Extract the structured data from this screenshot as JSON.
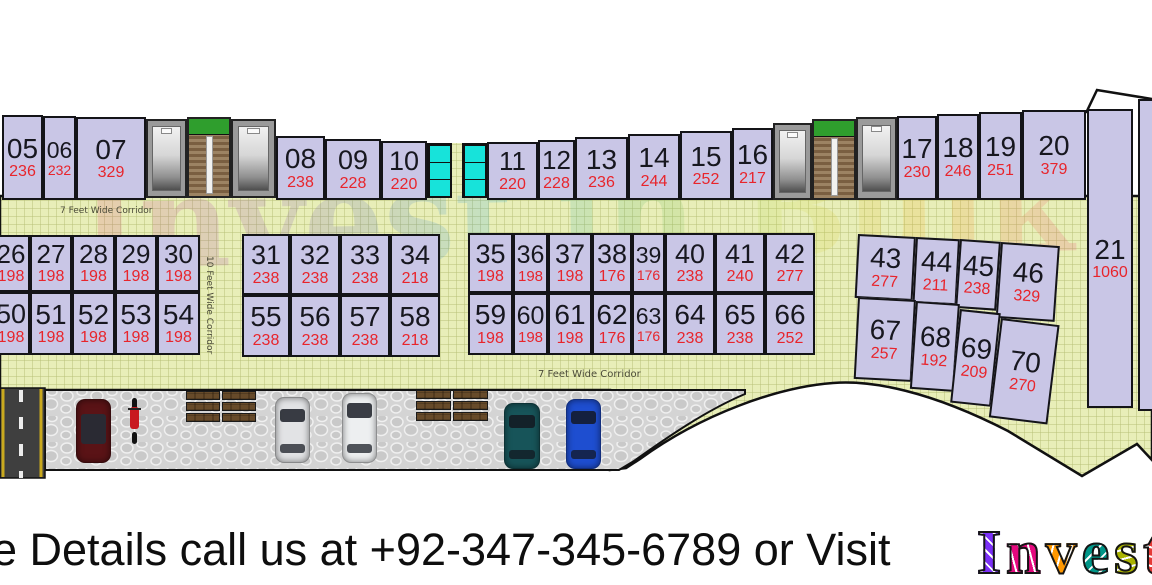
{
  "plan": {
    "corridor_top_label": "7 Feet Wide Corridor",
    "corridor_vertical_label": "10 Feet Wide Corridor",
    "corridor_bottom_label": "7 Feet Wide Corridor",
    "watermark": "Invest in Bulk",
    "units_top_row": [
      {
        "no": "05",
        "area": "236"
      },
      {
        "no": "06",
        "area": "232"
      },
      {
        "no": "07",
        "area": "329"
      },
      {
        "no": "08",
        "area": "238"
      },
      {
        "no": "09",
        "area": "228"
      },
      {
        "no": "10",
        "area": "220"
      },
      {
        "no": "11",
        "area": "220"
      },
      {
        "no": "12",
        "area": "228"
      },
      {
        "no": "13",
        "area": "236"
      },
      {
        "no": "14",
        "area": "244"
      },
      {
        "no": "15",
        "area": "252"
      },
      {
        "no": "16",
        "area": "217"
      },
      {
        "no": "17",
        "area": "230"
      },
      {
        "no": "18",
        "area": "246"
      },
      {
        "no": "19",
        "area": "251"
      },
      {
        "no": "20",
        "area": "379"
      },
      {
        "no": "21",
        "area": "1060"
      }
    ],
    "units_middle_row1": [
      {
        "no": "26",
        "area": "198"
      },
      {
        "no": "27",
        "area": "198"
      },
      {
        "no": "28",
        "area": "198"
      },
      {
        "no": "29",
        "area": "198"
      },
      {
        "no": "30",
        "area": "198"
      },
      {
        "no": "31",
        "area": "238"
      },
      {
        "no": "32",
        "area": "238"
      },
      {
        "no": "33",
        "area": "238"
      },
      {
        "no": "34",
        "area": "218"
      },
      {
        "no": "35",
        "area": "198"
      },
      {
        "no": "36",
        "area": "198"
      },
      {
        "no": "37",
        "area": "198"
      },
      {
        "no": "38",
        "area": "176"
      },
      {
        "no": "39",
        "area": "176"
      },
      {
        "no": "40",
        "area": "238"
      },
      {
        "no": "41",
        "area": "240"
      },
      {
        "no": "42",
        "area": "277"
      },
      {
        "no": "43",
        "area": "277"
      },
      {
        "no": "44",
        "area": "211"
      },
      {
        "no": "45",
        "area": "238"
      },
      {
        "no": "46",
        "area": "329"
      }
    ],
    "units_middle_row2": [
      {
        "no": "50",
        "area": "198"
      },
      {
        "no": "51",
        "area": "198"
      },
      {
        "no": "52",
        "area": "198"
      },
      {
        "no": "53",
        "area": "198"
      },
      {
        "no": "54",
        "area": "198"
      },
      {
        "no": "55",
        "area": "238"
      },
      {
        "no": "56",
        "area": "238"
      },
      {
        "no": "57",
        "area": "238"
      },
      {
        "no": "58",
        "area": "218"
      },
      {
        "no": "59",
        "area": "198"
      },
      {
        "no": "60",
        "area": "198"
      },
      {
        "no": "61",
        "area": "198"
      },
      {
        "no": "62",
        "area": "176"
      },
      {
        "no": "63",
        "area": "176"
      },
      {
        "no": "64",
        "area": "238"
      },
      {
        "no": "65",
        "area": "238"
      },
      {
        "no": "66",
        "area": "252"
      },
      {
        "no": "67",
        "area": "257"
      },
      {
        "no": "68",
        "area": "192"
      },
      {
        "no": "69",
        "area": "209"
      },
      {
        "no": "70",
        "area": "270"
      }
    ]
  },
  "footer": {
    "text": "e Details call us at +92-347-345-6789 or Visit",
    "logo": "Invest",
    "logo_colors": [
      "#7b2ff7",
      "#e5097f",
      "#ff9800",
      "#009688",
      "#aab300",
      "#e53935"
    ]
  },
  "colors": {
    "unit_fill": "#c9c6e6",
    "unit_number": "#17171f",
    "unit_area": "#e8242b",
    "corridor_fill": "#e8eeb8",
    "stairs_cyan": "#17e3da",
    "brick_cap_green": "#2f9e2d"
  }
}
